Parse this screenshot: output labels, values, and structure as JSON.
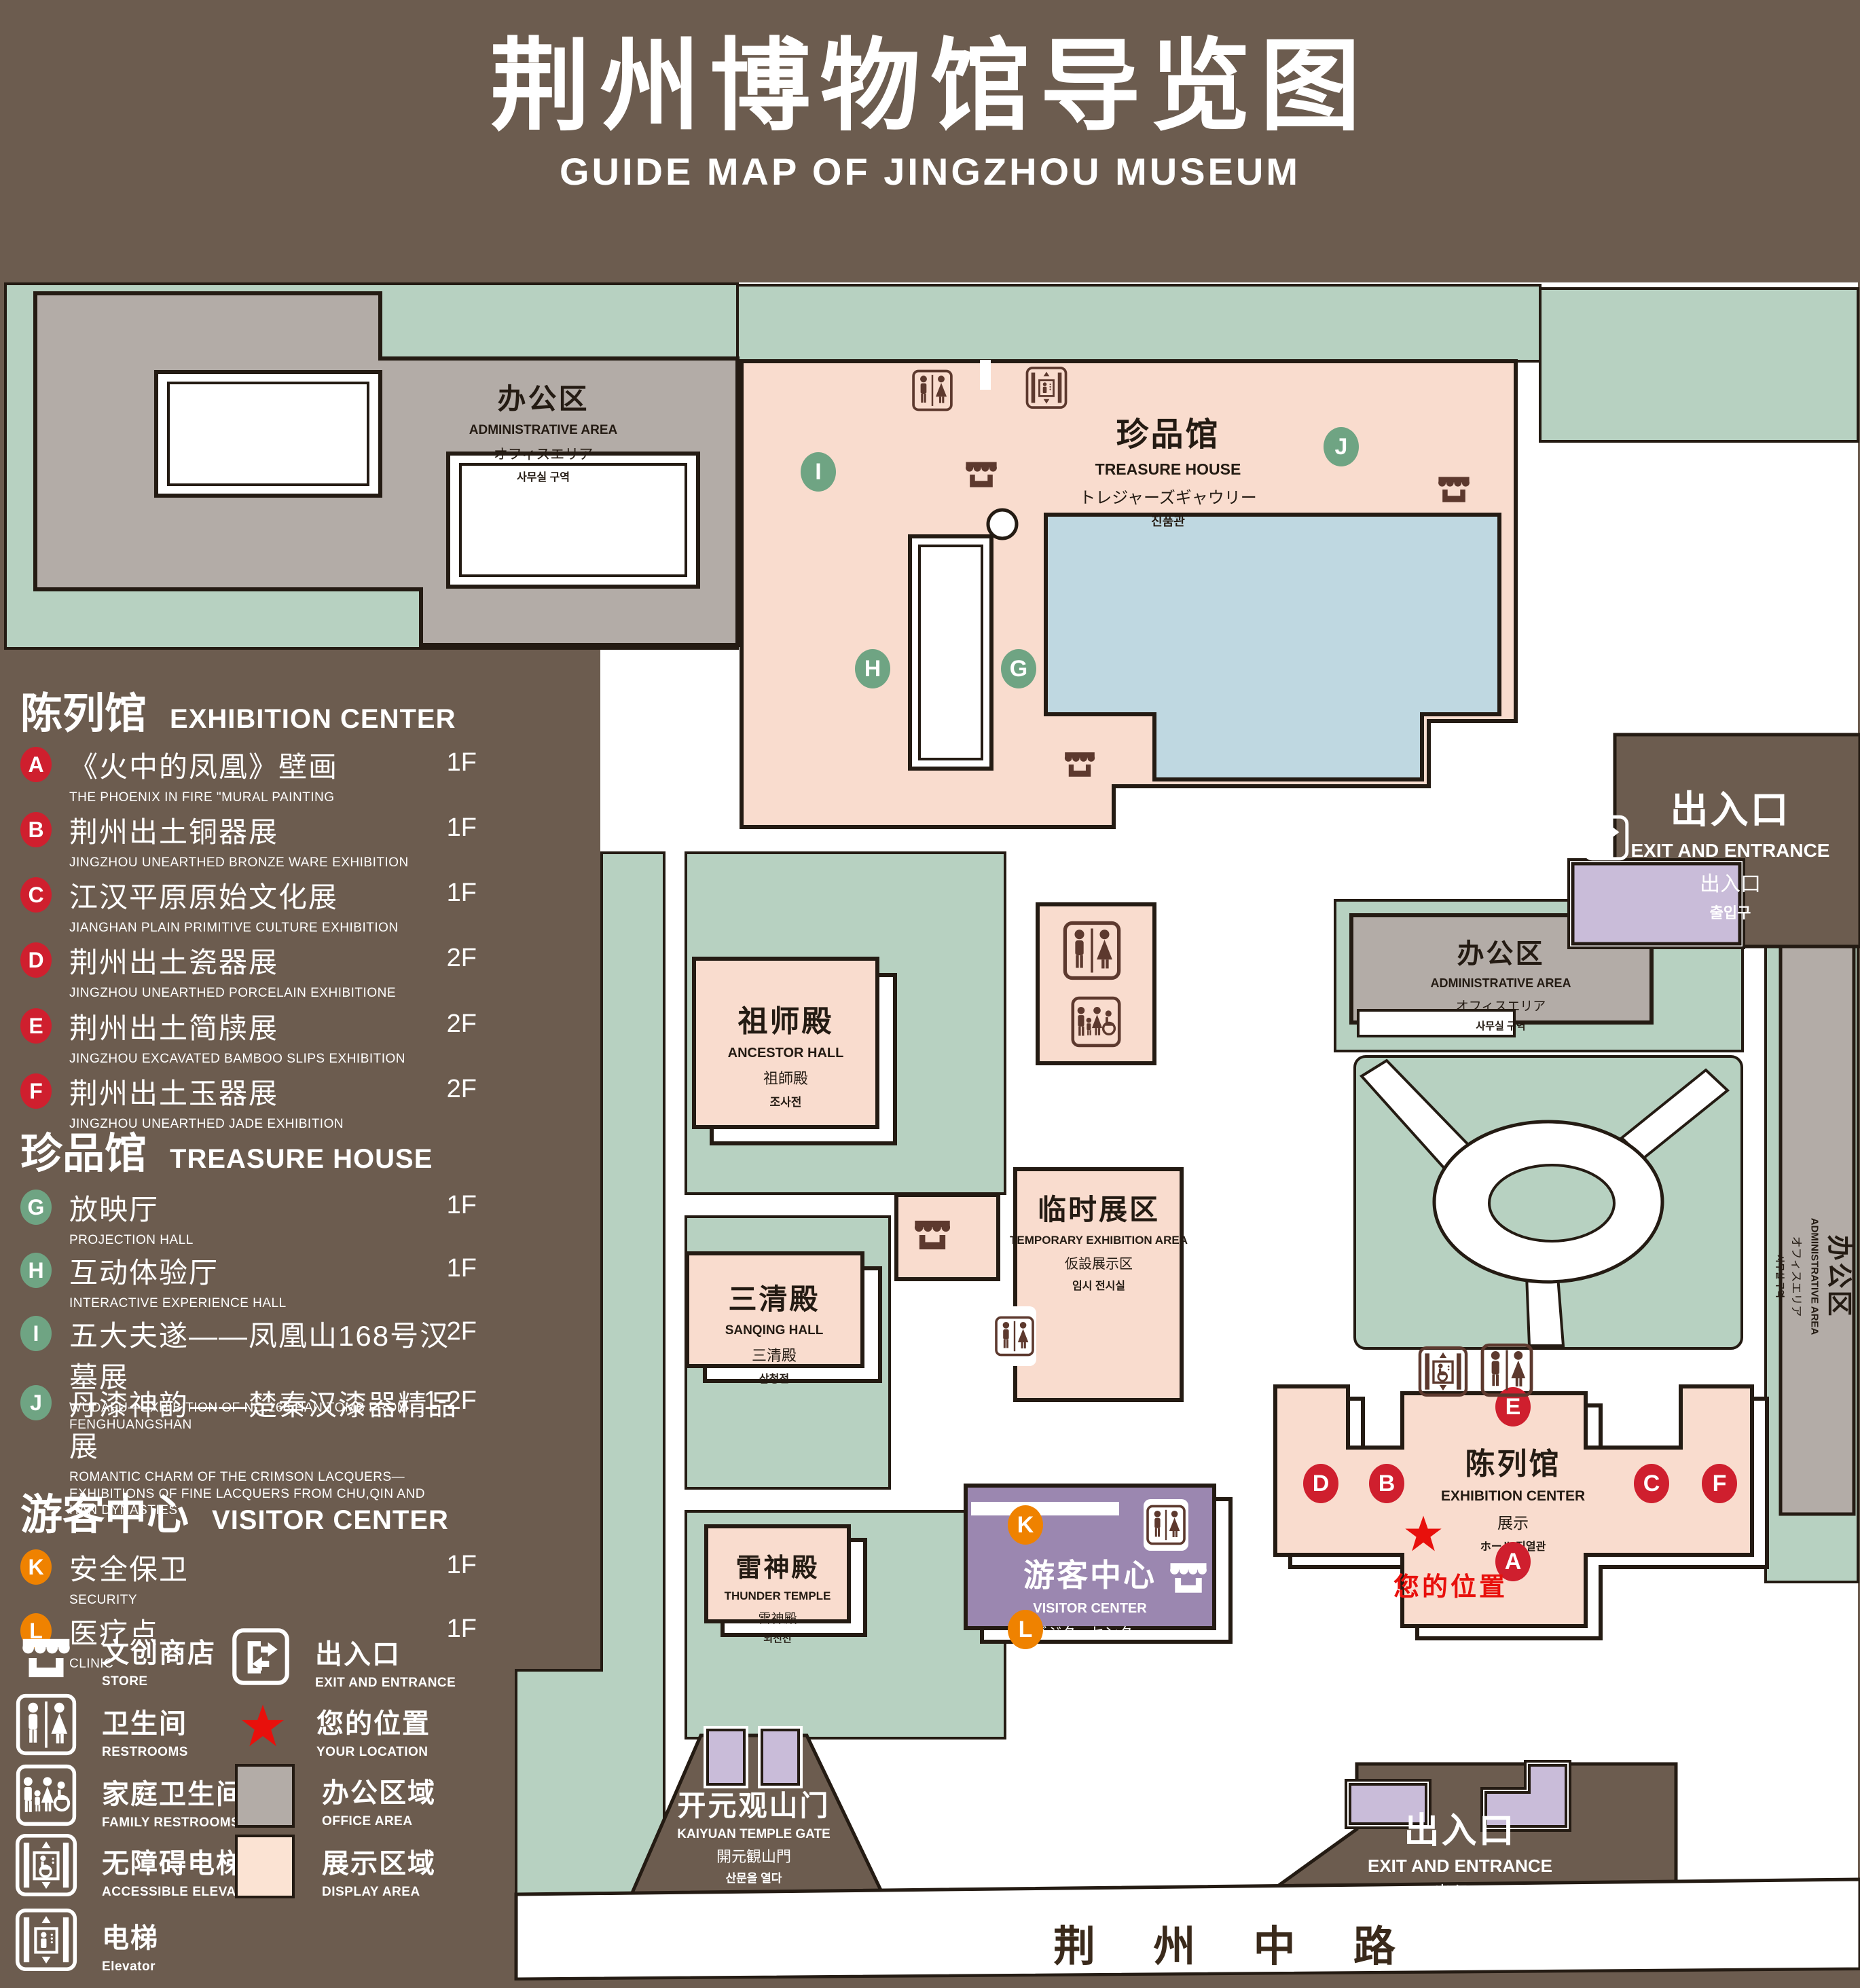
{
  "title": {
    "zh": "荆州博物馆导览图",
    "en": "GUIDE MAP OF JINGZHOU MUSEUM"
  },
  "palette": {
    "background": "#6c5c4f",
    "lawn_green": "#b7d1c1",
    "display_pink": "#f9dcce",
    "office_gray": "#b3aca7",
    "pond_blue": "#bfd8e1",
    "visitor_purple": "#9b87b0",
    "light_purple": "#c9bcd9",
    "outline": "#241b13",
    "marker_red": "#cf1f2e",
    "marker_green": "#6fa483",
    "marker_orange": "#ef8200",
    "location_red": "#e8100c",
    "icon_brown": "#5d392e"
  },
  "legend": {
    "sections": [
      {
        "zh": "陈列馆",
        "en": "EXHIBITION CENTER",
        "items": [
          {
            "letter": "A",
            "zh": "《火中的凤凰》壁画",
            "en": "THE PHOENIX IN FIRE \"MURAL PAINTING",
            "floor": "1F"
          },
          {
            "letter": "B",
            "zh": "荆州出土铜器展",
            "en": "JINGZHOU UNEARTHED BRONZE WARE EXHIBITION",
            "floor": "1F"
          },
          {
            "letter": "C",
            "zh": "江汉平原原始文化展",
            "en": "JIANGHAN PLAIN PRIMITIVE CULTURE EXHIBITION",
            "floor": "1F"
          },
          {
            "letter": "D",
            "zh": "荆州出土瓷器展",
            "en": "JINGZHOU UNEARTHED PORCELAIN EXHIBITIONE",
            "floor": "2F"
          },
          {
            "letter": "E",
            "zh": "荆州出土简牍展",
            "en": "JINGZHOU EXCAVATED BAMBOO SLIPS EXHIBITION",
            "floor": "2F"
          },
          {
            "letter": "F",
            "zh": "荆州出土玉器展",
            "en": "JINGZHOU UNEARTHED JADE EXHIBITION",
            "floor": "2F"
          }
        ]
      },
      {
        "zh": "珍品馆",
        "en": "TREASURE HOUSE",
        "items": [
          {
            "letter": "G",
            "zh": "放映厅",
            "en": "PROJECTION HALL",
            "floor": "1F"
          },
          {
            "letter": "H",
            "zh": "互动体验厅",
            "en": "INTERACTIVE EXPERIENCE HALL",
            "floor": "1F"
          },
          {
            "letter": "I",
            "zh": "五大夫遂——凤凰山168号汉墓展",
            "en": "WUDAFU—EXHIBITION OF NO.168 HAN TOMB FROM FENGHUANGSHAN",
            "floor": "2F"
          },
          {
            "letter": "J",
            "zh": "丹漆神韵——楚秦汉漆器精品展",
            "en": "ROMANTIC CHARM OF THE CRIMSON LACQUERS—EXHIBITIONS OF FINE LACQUERS FROM CHU,QIN AND HAN DYNASTIES",
            "floor": "1-2F"
          }
        ]
      },
      {
        "zh": "游客中心",
        "en": "VISITOR CENTER",
        "items": [
          {
            "letter": "K",
            "zh": "安全保卫",
            "en": "SECURITY",
            "floor": "1F"
          },
          {
            "letter": "L",
            "zh": "医疗点",
            "en": "CLINIC",
            "floor": "1F"
          }
        ]
      }
    ],
    "symbols": [
      {
        "zh": "文创商店",
        "en": "STORE"
      },
      {
        "zh": "卫生间",
        "en": "RESTROOMS"
      },
      {
        "zh": "家庭卫生间",
        "en": "FAMILY RESTROOMS"
      },
      {
        "zh": "无障碍电梯",
        "en": "ACCESSIBLE ELEVATOR"
      },
      {
        "zh": "电梯",
        "en": "Elevator"
      },
      {
        "zh": "出入口",
        "en": "EXIT AND ENTRANCE"
      },
      {
        "zh": "您的位置",
        "en": "YOUR LOCATION"
      },
      {
        "zh": "办公区域",
        "en": "OFFICE AREA"
      },
      {
        "zh": "展示区域",
        "en": "DISPLAY AREA"
      }
    ]
  },
  "map": {
    "buildings": {
      "admin": {
        "zh": "办公区",
        "en": "ADMINISTRATIVE AREA",
        "ja": "オフィスエリア",
        "ko": "사무실 구역"
      },
      "treasure": {
        "zh": "珍品馆",
        "en": "TREASURE HOUSE",
        "ja": "トレジャーズギャウリー",
        "ko": "진품관"
      },
      "ancestor": {
        "zh": "祖师殿",
        "en": "ANCESTOR HALL",
        "ja": "祖師殿",
        "ko": "조사전"
      },
      "temporary": {
        "zh": "临时展区",
        "en": "TEMPORARY EXHIBITION AREA",
        "ja": "仮設展示区",
        "ko": "임시 전시실"
      },
      "sanqing": {
        "zh": "三清殿",
        "en": "SANQING HALL",
        "ja": "三清殿",
        "ko": "삼청전"
      },
      "thunder": {
        "zh": "雷神殿",
        "en": "THUNDER TEMPLE",
        "ja": "雷神殿",
        "ko": "뇌신전"
      },
      "visitor": {
        "zh": "游客中心",
        "en": "VISITOR CENTER",
        "ja": "ビジターセンター",
        "ko": "관광객 센터"
      },
      "exhibition": {
        "zh": "陈列馆",
        "en": "EXHIBITION CENTER",
        "ja": "展示",
        "ko": "ホール 진열관"
      },
      "gate": {
        "zh": "开元观山门",
        "en": "KAIYUAN TEMPLE GATE",
        "ja": "開元観山門",
        "ko": "산문을 열다"
      },
      "exit": {
        "zh": "出入口",
        "en": "EXIT AND ENTRANCE",
        "ja": "出入口",
        "ko": "출입구"
      }
    },
    "markers": {
      "A": "A",
      "B": "B",
      "C": "C",
      "D": "D",
      "E": "E",
      "F": "F",
      "G": "G",
      "H": "H",
      "I": "I",
      "J": "J",
      "K": "K",
      "L": "L"
    },
    "your_location": "您的位置",
    "road": "荆 州 中 路"
  }
}
